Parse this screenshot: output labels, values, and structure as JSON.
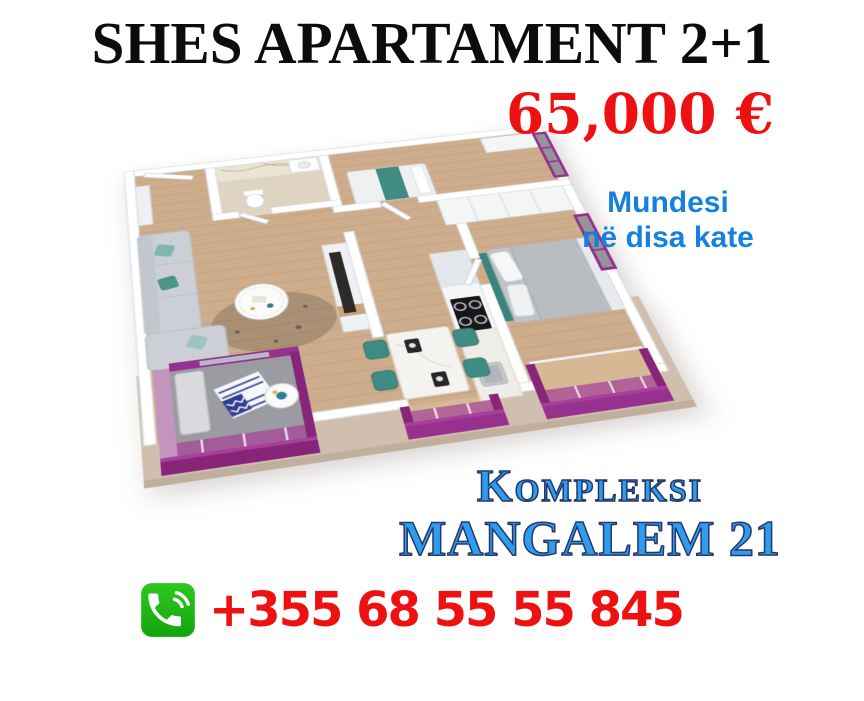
{
  "title": "SHES APARTAMENT 2+1",
  "price": "65,000 €",
  "availability": {
    "line1": "Mundesi",
    "line2": "në disa kate"
  },
  "complex": {
    "line1": "Kompleksi",
    "line2": "MANGALEM 21"
  },
  "contact": {
    "phone_number": "+355 68 55 55 845",
    "icon": "phone-call-icon"
  },
  "floor_plan": {
    "description": "3D isometric render of a 2+1 apartment with purple accents",
    "rooms": [
      "entrance hall",
      "bathroom",
      "living room",
      "kitchen & dining",
      "bedroom 1",
      "bedroom 2",
      "balcony 1",
      "balcony 2",
      "balcony 3"
    ]
  },
  "theme": {
    "title_color": "#0c0c0c",
    "red": "#ee1111",
    "blue_deep": "#1580dd",
    "blue_light": "#2f9ced",
    "navy": "#25386b",
    "green": "#2cc91d",
    "green_dark": "#14a50e",
    "magenta": "#97308f",
    "magenta_dark": "#872579",
    "pink": "#c394be",
    "tan": "#d0bfae",
    "wood": "#cead8d",
    "teal": "#3f8c85",
    "gray_floor": "#9b9ba2"
  }
}
